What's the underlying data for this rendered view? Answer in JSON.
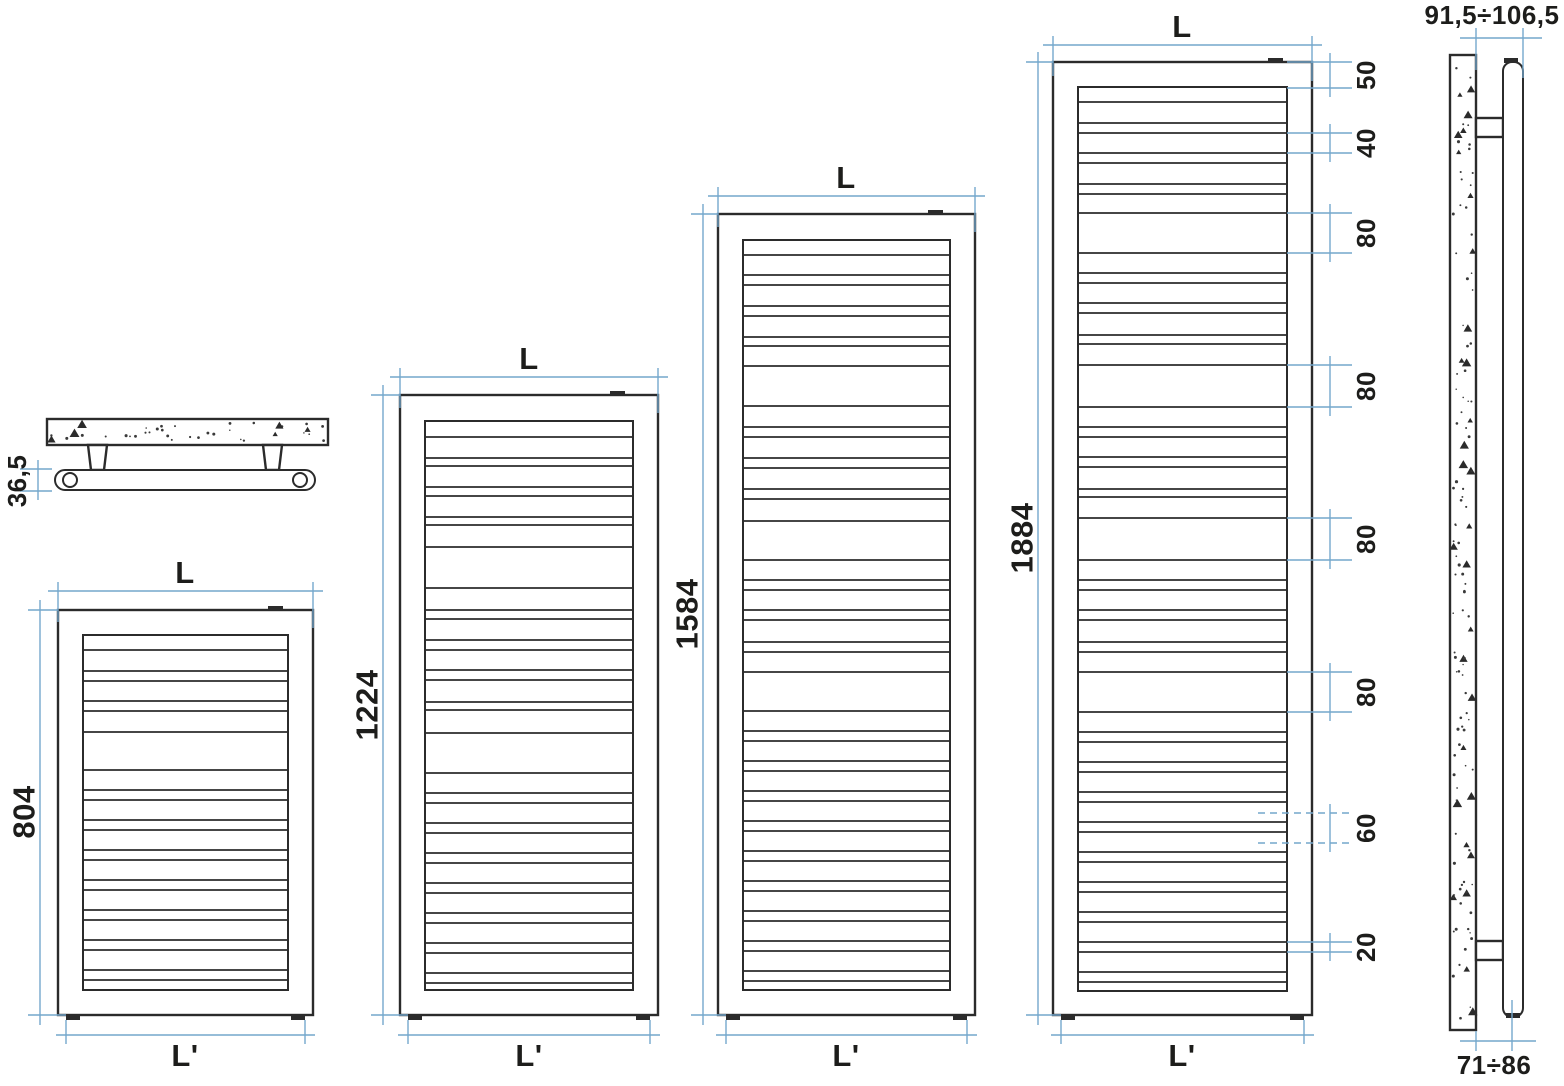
{
  "diagram": {
    "type": "radiator-technical-drawing",
    "views": {
      "top_view": {
        "depth_label": "36,5"
      },
      "side_view": {
        "distance_top_label": "91,5÷106,5",
        "distance_bottom_label": "71÷86"
      }
    },
    "radiators": [
      {
        "width_label": "L",
        "height_label": "804",
        "base_width_label": "L'"
      },
      {
        "width_label": "L",
        "height_label": "1224",
        "base_width_label": "L'"
      },
      {
        "width_label": "L",
        "height_label": "1584",
        "base_width_label": "L'"
      },
      {
        "width_label": "L",
        "height_label": "1884",
        "base_width_label": "L'"
      }
    ],
    "pitch_labels": [
      "50",
      "40",
      "80",
      "80",
      "80",
      "80",
      "60",
      "20"
    ],
    "colors": {
      "line": "#2b2b2b",
      "dimension": "#74a7cc",
      "label": "#1d1d1b",
      "background": "#ffffff"
    }
  }
}
